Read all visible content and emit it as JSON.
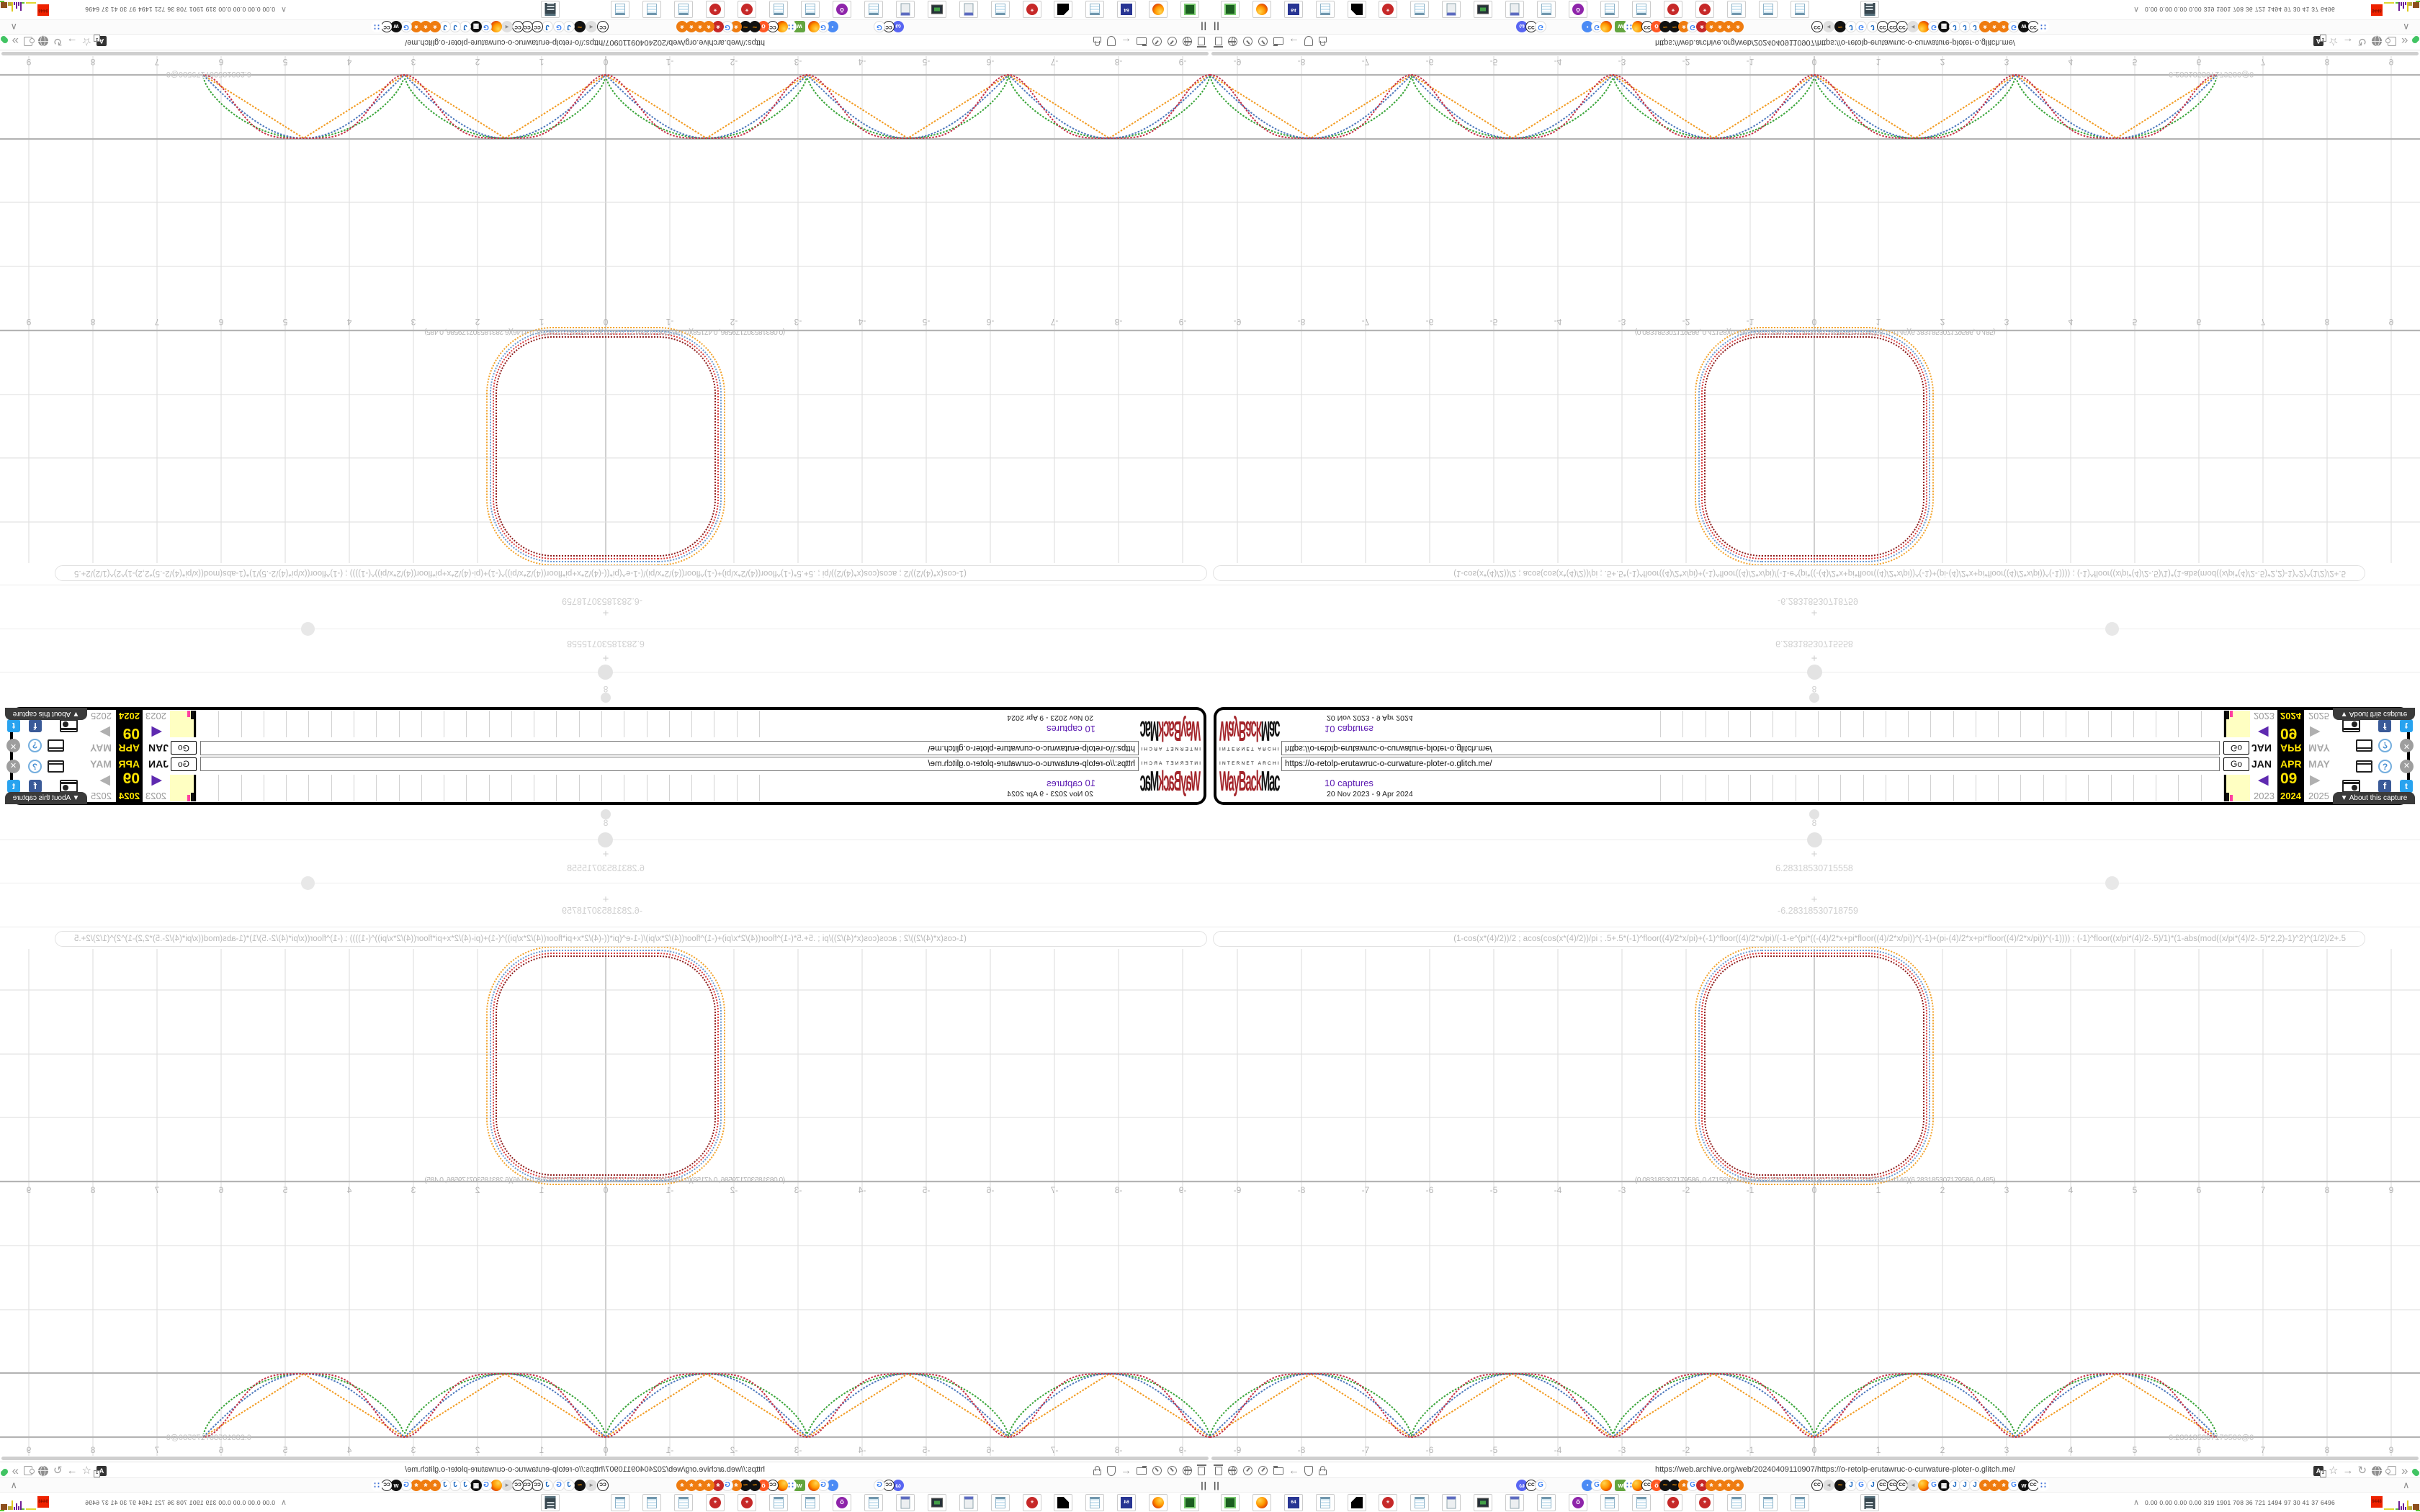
{
  "wayback": {
    "logo_top": "INTERNET ARCHIVE",
    "logo_red": "WayBack",
    "logo_black": "Machine",
    "url_value": "https://o-retolp-erutawruc-o-curwature-ploter-o.glitch.me/",
    "go_label": "Go",
    "captures_link": "10 captures",
    "date_range": "20 Nov 2023 - 9 Apr 2024",
    "month_prev": "JAN",
    "month_cur": "APR",
    "month_next": "MAY",
    "day": "09",
    "year_prev": "2023",
    "year_cur": "2024",
    "year_next": "2025",
    "prev_arrow": "◀",
    "next_arrow": "▶",
    "help_glyph": "?",
    "close_glyph": "✕",
    "fb_glyph": "f",
    "tw_glyph": "t",
    "about_label": "▼ About this capture",
    "sparkline_ticks": 26,
    "accent_yellow": "#ffe400",
    "accent_purple": "#5816b0"
  },
  "plotter": {
    "formula": "(1-cos(x*(4)/2))/2 ; acos(cos(x*(4)/2))/pi ; .5+.5*(-1)^floor((4)/2*x/pi)+(-1)^floor((4)/2*x/pi)/(-1-e^(pi*((-(4)/2*x+pi*floor((4)/2*x/pi))^(-1)+(pi-(4)/2*x+pi*floor((4)/2*x/pi))^(-1)))) ; (-1)^floor((x/pi*(4)/2-.5)/1)*(1-abs(mod((x/pi*(4)/2-.5)*2,2)-1)^2)^(1/2)/2+.5",
    "param_value": "8",
    "range_max": "6.28318530715558",
    "range_min": "-6.28318530718759",
    "endpoint_label": "6.283185307179586@0",
    "overlap_label": "(0.083185307179586, 0.47158)(0.166370614359172, 0.4431)(0.249555921538758, 0.4146)(6.283185307179586, 0.485)",
    "axis_min": -9,
    "axis_max": 9
  },
  "chart_data": [
    {
      "type": "line",
      "title": "Wave interpolation plot (triangle to square wave family)",
      "xlabel": "x (radians)",
      "ylabel": "y",
      "x_range": [
        -9.42477,
        6.28318
      ],
      "y_range": [
        0,
        1
      ],
      "grid": true,
      "series": [
        {
          "name": "triangle wave (2/pi)*asin(|sin x|)",
          "color": "#f29a1f"
        },
        {
          "name": "|sin x|",
          "color": "#4b77bc"
        },
        {
          "name": "intermediate |sin x|^0.62",
          "color": "#37a437"
        },
        {
          "name": "rounded square 0.5-0.5cos(pi|sin x|)",
          "color": "#c62f45"
        }
      ],
      "notes": "zeros at integer multiples of pi, peaks y=1 at odd multiples of pi/2, curves end at x=2pi with point label 6.283185307179586@0",
      "x_tick_labels": [
        -9,
        -8,
        -7,
        -6,
        -5,
        -4,
        -3,
        -2,
        -1,
        0,
        1,
        2,
        3,
        4,
        5,
        6,
        7,
        8,
        9
      ]
    },
    {
      "type": "line",
      "title": "Nested squircle (rounded-square closed curves)",
      "center": [
        0,
        0
      ],
      "half_width_units": 1.85,
      "series": [
        {
          "name": "outer",
          "color": "#f2a229"
        },
        {
          "name": "second",
          "color": "#6b9bd2"
        },
        {
          "name": "third",
          "color": "#d94040"
        },
        {
          "name": "inner",
          "color": "#8f1d1d"
        }
      ],
      "x_tick_labels": [
        -9,
        -8,
        -7,
        -6,
        -5,
        -4,
        -3,
        -2,
        -1,
        0,
        1,
        2,
        3,
        4,
        5,
        6,
        7,
        8,
        9
      ],
      "parameters": {
        "segments": "8",
        "x_max": "6.28318530715558",
        "x_min": "-6.28318530718759"
      }
    }
  ],
  "browser": {
    "url": "https://web.archive.org/web/20240409110907/https://o-retolp-erutawruc-o-curwature-ploter-o.glitch.me/",
    "pause_glyph": "||",
    "collapse_glyph": "∧",
    "stats_numbers": "0.00 0.00 0.00 0.00  319 1901 708  36  721 1494  97   30   41   37 6496",
    "stats_badge": "9448",
    "left_icons": [
      "trash",
      "globe",
      "gauge",
      "gauge",
      "folder",
      "back-arrow",
      "shield",
      "lock"
    ],
    "right_icons": [
      "translate",
      "star",
      "forward-arrow",
      "reload",
      "globe-dark",
      "puzzle",
      "chevrons",
      "green-dot"
    ],
    "favicons": [
      [
        425,
        "discord"
      ],
      [
        438,
        "cc"
      ],
      [
        451,
        "google"
      ],
      [
        516,
        "bubble"
      ],
      [
        529,
        "google"
      ],
      [
        542,
        "firefox"
      ],
      [
        562,
        "glitch"
      ],
      [
        574,
        "dots"
      ],
      [
        586,
        "firefox"
      ],
      [
        599,
        "cc"
      ],
      [
        612,
        "reddit"
      ],
      [
        624,
        "wave"
      ],
      [
        637,
        "wave"
      ],
      [
        650,
        "gear-o"
      ],
      [
        662,
        "google"
      ],
      [
        675,
        "gear-r"
      ],
      [
        688,
        "gear-o"
      ],
      [
        700,
        "gear-o"
      ],
      [
        712,
        "gear-o"
      ],
      [
        725,
        "gear-o"
      ],
      [
        835,
        "cc"
      ],
      [
        851,
        "speaker"
      ],
      [
        867,
        "wave"
      ],
      [
        882,
        "java"
      ],
      [
        896,
        "google"
      ],
      [
        912,
        "java"
      ],
      [
        926,
        "cc"
      ],
      [
        940,
        "cc"
      ],
      [
        953,
        "cc"
      ],
      [
        968,
        "speaker"
      ],
      [
        983,
        "firefox"
      ],
      [
        997,
        "google"
      ],
      [
        1011,
        "grid"
      ],
      [
        1026,
        "java"
      ],
      [
        1040,
        "java"
      ],
      [
        1054,
        "java"
      ],
      [
        1068,
        "gear-o"
      ],
      [
        1081,
        "gear-o"
      ],
      [
        1094,
        "gear-o"
      ],
      [
        1108,
        "google"
      ],
      [
        1122,
        "bird"
      ],
      [
        1135,
        "cc"
      ],
      [
        1149,
        "dots"
      ]
    ],
    "bookmarks": [
      [
        15,
        "console"
      ],
      [
        59,
        "firefox"
      ],
      [
        103,
        "floppy"
      ],
      [
        147,
        "notepad"
      ],
      [
        191,
        "cat"
      ],
      [
        234,
        "gear-r"
      ],
      [
        278,
        "notepad"
      ],
      [
        322,
        "calc"
      ],
      [
        366,
        "monitor"
      ],
      [
        410,
        "calc"
      ],
      [
        454,
        "notepad"
      ],
      [
        498,
        "owl"
      ],
      [
        542,
        "notepad"
      ],
      [
        586,
        "notepad"
      ],
      [
        630,
        "gear-r"
      ],
      [
        674,
        "gear-r"
      ],
      [
        718,
        "notepad"
      ],
      [
        762,
        "notepad"
      ],
      [
        806,
        "notepad"
      ],
      [
        903,
        "doc"
      ]
    ]
  }
}
